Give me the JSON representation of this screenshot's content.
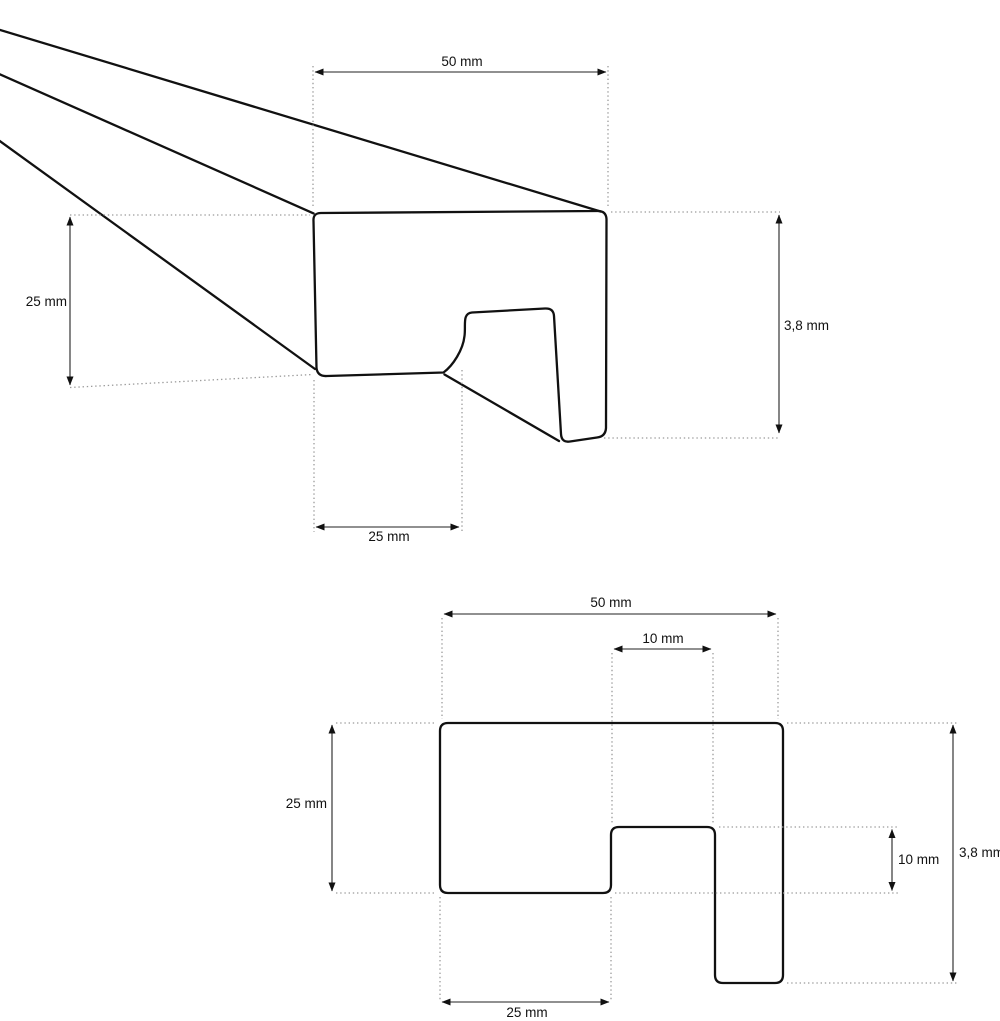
{
  "drawing": {
    "type": "technical-drawing",
    "perspective_view": {
      "dim_width": "50 mm",
      "dim_height": "25 mm",
      "dim_total_height": "3,8 mm",
      "dim_bottom_width": "25 mm"
    },
    "cross_section_view": {
      "dim_width": "50 mm",
      "dim_notch_width": "10 mm",
      "dim_height": "25 mm",
      "dim_notch_depth": "10 mm",
      "dim_total_height": "3,8 mm",
      "dim_bottom_width": "25 mm"
    },
    "colors": {
      "outline": "#111111",
      "dimension_line": "#222222",
      "extension_line": "#9b9b9b",
      "background": "#ffffff",
      "text": "#111111"
    }
  }
}
